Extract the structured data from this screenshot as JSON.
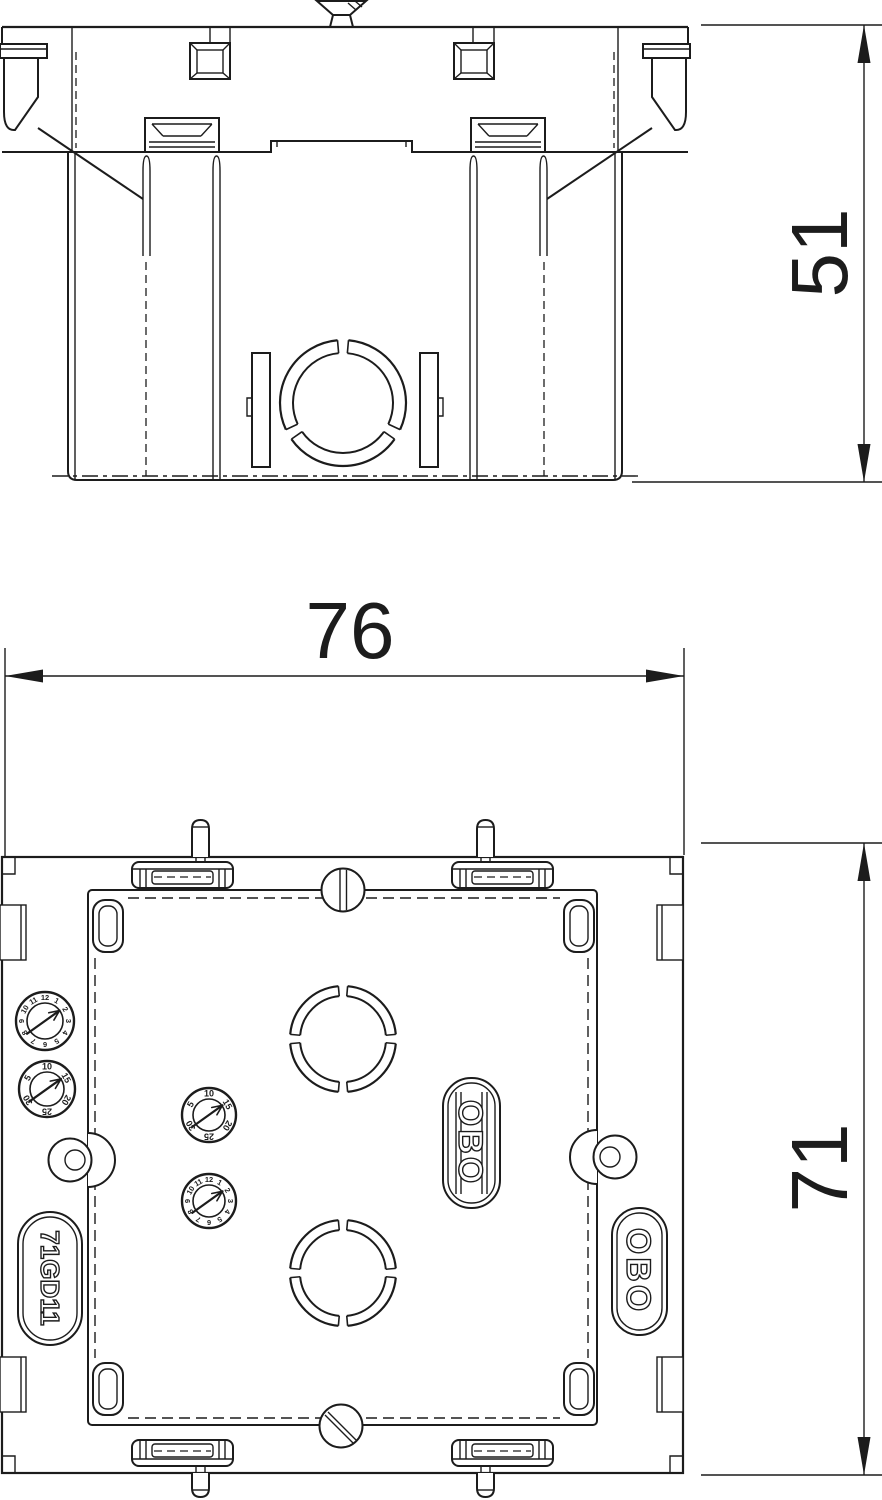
{
  "page": {
    "background": "#ffffff",
    "line_color": "#1c1c1c"
  },
  "product": {
    "code": "71GD11",
    "brand": "OBO"
  },
  "dimensions": {
    "side_view_height": "51",
    "overall_width": "76",
    "plan_view_height": "71"
  },
  "labels": {
    "product_pill": "71GD11",
    "brand_pill_inner": "OBO",
    "brand_pill_outer": "OBO"
  },
  "dials": {
    "clock_numbers": [
      "12",
      "1",
      "2",
      "3",
      "4",
      "5",
      "6",
      "7",
      "8",
      "9",
      "10",
      "11"
    ],
    "day_numbers": [
      "10",
      "15",
      "20",
      "25",
      "30",
      "5"
    ]
  }
}
